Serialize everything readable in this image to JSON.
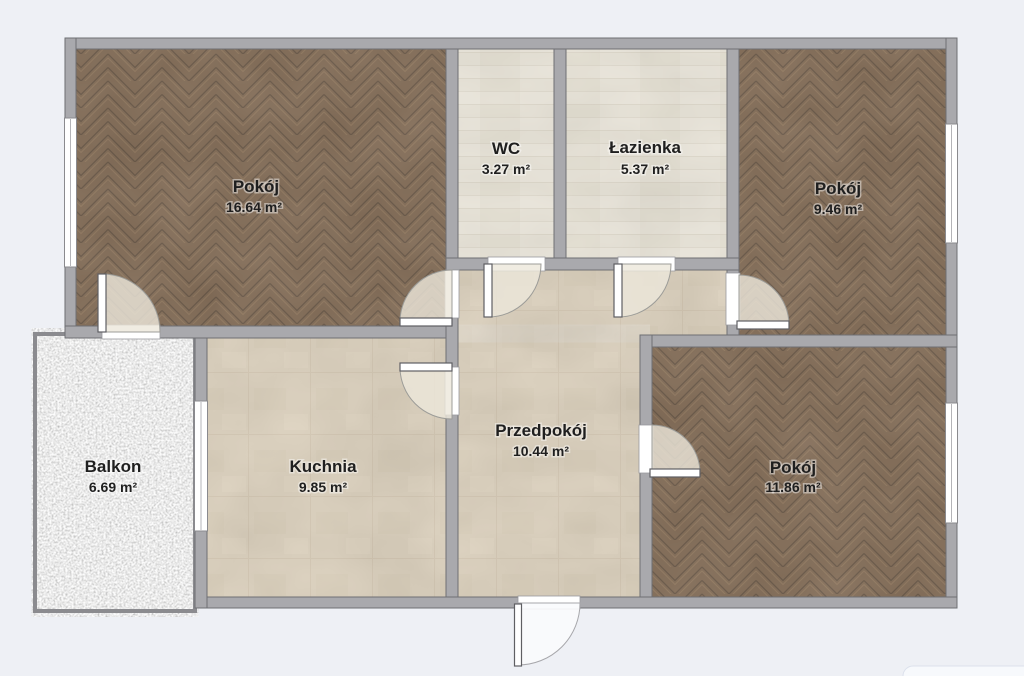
{
  "plan_title": "Apartment floor plan",
  "rooms": {
    "pokoj_tl": {
      "name": "Pokój",
      "area": "16.64 m²"
    },
    "wc": {
      "name": "WC",
      "area": "3.27 m²"
    },
    "lazienka": {
      "name": "Łazienka",
      "area": "5.37 m²"
    },
    "pokoj_tr": {
      "name": "Pokój",
      "area": "9.46 m²"
    },
    "balkon": {
      "name": "Balkon",
      "area": "6.69 m²"
    },
    "kuchnia": {
      "name": "Kuchnia",
      "area": "9.85 m²"
    },
    "przedpokoj": {
      "name": "Przedpokój",
      "area": "10.44 m²"
    },
    "pokoj_br": {
      "name": "Pokój",
      "area": "11.86 m²"
    }
  },
  "palette": {
    "background": "#eef0f5",
    "wall": "#a9a9ad",
    "wall_outline": "#6e6f73",
    "wood_floor": "#6d533a",
    "bathroom_tile": "#e3ded1",
    "kitchen_tile": "#d3c6af",
    "balcony_concrete": "#ededeb",
    "door_swing": "#ece7db"
  }
}
